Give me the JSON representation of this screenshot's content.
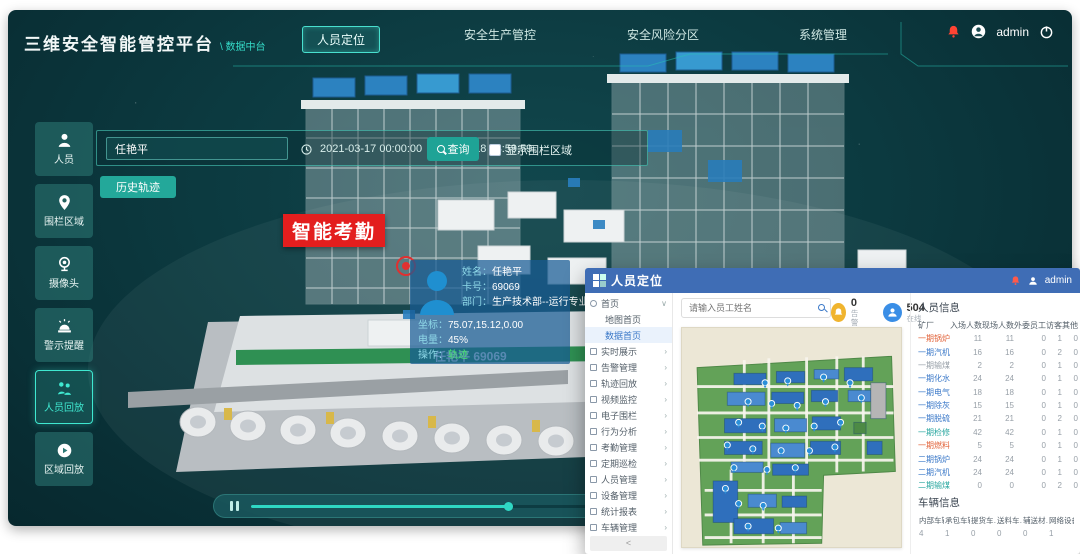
{
  "app": {
    "header": {
      "title": "三维安全智能管控平台",
      "subtitle": "\\ 数据中台",
      "tabs": [
        {
          "label": "人员定位",
          "active": true
        },
        {
          "label": "安全生产管控",
          "active": false
        },
        {
          "label": "安全风险分区",
          "active": false
        },
        {
          "label": "系统管理",
          "active": false
        }
      ],
      "user": "admin"
    },
    "sidebar": [
      {
        "label": "人员",
        "icon": "person-icon",
        "active": false
      },
      {
        "label": "围栏区域",
        "icon": "fence-pin-icon",
        "active": false
      },
      {
        "label": "摄像头",
        "icon": "camera-icon",
        "active": false
      },
      {
        "label": "警示提醒",
        "icon": "alarm-icon",
        "active": false
      },
      {
        "label": "人员回放",
        "icon": "people-playback-icon",
        "active": true
      },
      {
        "label": "区域回放",
        "icon": "area-playback-icon",
        "active": false
      }
    ],
    "toolbar": {
      "person_value": "任艳平",
      "date_start": "2021-03-17 00:00:00",
      "date_end": "2021-03-18 23:59:59",
      "query_label": "查询",
      "checkbox_label": "显示围栏区域",
      "track_label": "历史轨迹"
    },
    "scene": {
      "badge": "智能考勤",
      "person_tag": "任艳平 69069",
      "tooltip": [
        {
          "label": "姓名：",
          "value": "任艳平"
        },
        {
          "label": "卡号：",
          "value": "69069"
        },
        {
          "label": "部门：",
          "value": "生产技术部--运行专业"
        },
        {
          "label": "坐标：",
          "value": "75.07,15.12,0.00"
        },
        {
          "label": "电量：",
          "value": "45%"
        },
        {
          "label": "操作：",
          "value": "轨迹",
          "link": true
        }
      ],
      "player_progress": 32
    }
  },
  "overlay": {
    "title": "人员定位",
    "user": "admin",
    "menu": {
      "root": {
        "label": "首页",
        "icon": "home-icon",
        "expanded": true
      },
      "children": [
        {
          "label": "地图首页",
          "active": false
        },
        {
          "label": "数据首页",
          "active": true
        }
      ],
      "items": [
        {
          "label": "实时展示",
          "icon": "monitor-icon"
        },
        {
          "label": "告警管理",
          "icon": "alert-icon"
        },
        {
          "label": "轨迹回放",
          "icon": "track-icon"
        },
        {
          "label": "视频监控",
          "icon": "video-icon"
        },
        {
          "label": "电子围栏",
          "icon": "fence-icon"
        },
        {
          "label": "行为分析",
          "icon": "behavior-icon"
        },
        {
          "label": "考勤管理",
          "icon": "attendance-icon"
        },
        {
          "label": "定期巡检",
          "icon": "inspection-icon"
        },
        {
          "label": "人员管理",
          "icon": "people-icon"
        },
        {
          "label": "设备管理",
          "icon": "device-icon"
        },
        {
          "label": "统计报表",
          "icon": "report-icon"
        },
        {
          "label": "车辆管理",
          "icon": "vehicle-icon"
        }
      ],
      "collapse": "<"
    },
    "search_placeholder": "请输入员工姓名",
    "stats": [
      {
        "value": "0",
        "label": "告警",
        "color": "#f0b42e",
        "icon": "alarm-count-icon"
      },
      {
        "value": "504",
        "label": "在线",
        "color": "#3a8ee6",
        "icon": "online-count-icon"
      }
    ],
    "person_info": {
      "title": "人员信息",
      "columns": [
        "矿厂",
        "入场人数",
        "现场人数",
        "外委员工",
        "访客",
        "其他"
      ],
      "rows": [
        {
          "name": "一期锅炉",
          "color": "#e2633a",
          "values": [
            11,
            11,
            0,
            1,
            0
          ]
        },
        {
          "name": "一期汽机",
          "color": "#3a78c8",
          "values": [
            16,
            16,
            0,
            2,
            0
          ]
        },
        {
          "name": "一期输煤",
          "color": "#98a0a8",
          "values": [
            2,
            2,
            0,
            1,
            0
          ]
        },
        {
          "name": "一期化水",
          "color": "#3a78c8",
          "values": [
            24,
            24,
            0,
            1,
            0
          ]
        },
        {
          "name": "一期电气",
          "color": "#3a78c8",
          "values": [
            18,
            18,
            0,
            1,
            0
          ]
        },
        {
          "name": "一期除灰",
          "color": "#3a78c8",
          "values": [
            15,
            15,
            0,
            1,
            0
          ]
        },
        {
          "name": "一期脱硫",
          "color": "#3a78c8",
          "values": [
            21,
            21,
            0,
            2,
            0
          ]
        },
        {
          "name": "一期检修",
          "color": "#2aa7a0",
          "values": [
            42,
            42,
            0,
            1,
            0
          ]
        },
        {
          "name": "一期燃料",
          "color": "#e2633a",
          "values": [
            5,
            5,
            0,
            1,
            0
          ]
        },
        {
          "name": "二期锅炉",
          "color": "#3a78c8",
          "values": [
            24,
            24,
            0,
            1,
            0
          ]
        },
        {
          "name": "二期汽机",
          "color": "#3a78c8",
          "values": [
            24,
            24,
            0,
            1,
            0
          ]
        },
        {
          "name": "二期输煤",
          "color": "#2aa7a0",
          "values": [
            0,
            0,
            0,
            2,
            0
          ]
        }
      ]
    },
    "vehicle_info": {
      "title": "车辆信息",
      "columns": [
        "内部车辆",
        "承包车辆",
        "提货车…",
        "送料车…",
        "辅送材…",
        "网络设备"
      ],
      "values": [
        4,
        1,
        0,
        0,
        0,
        1
      ]
    }
  }
}
